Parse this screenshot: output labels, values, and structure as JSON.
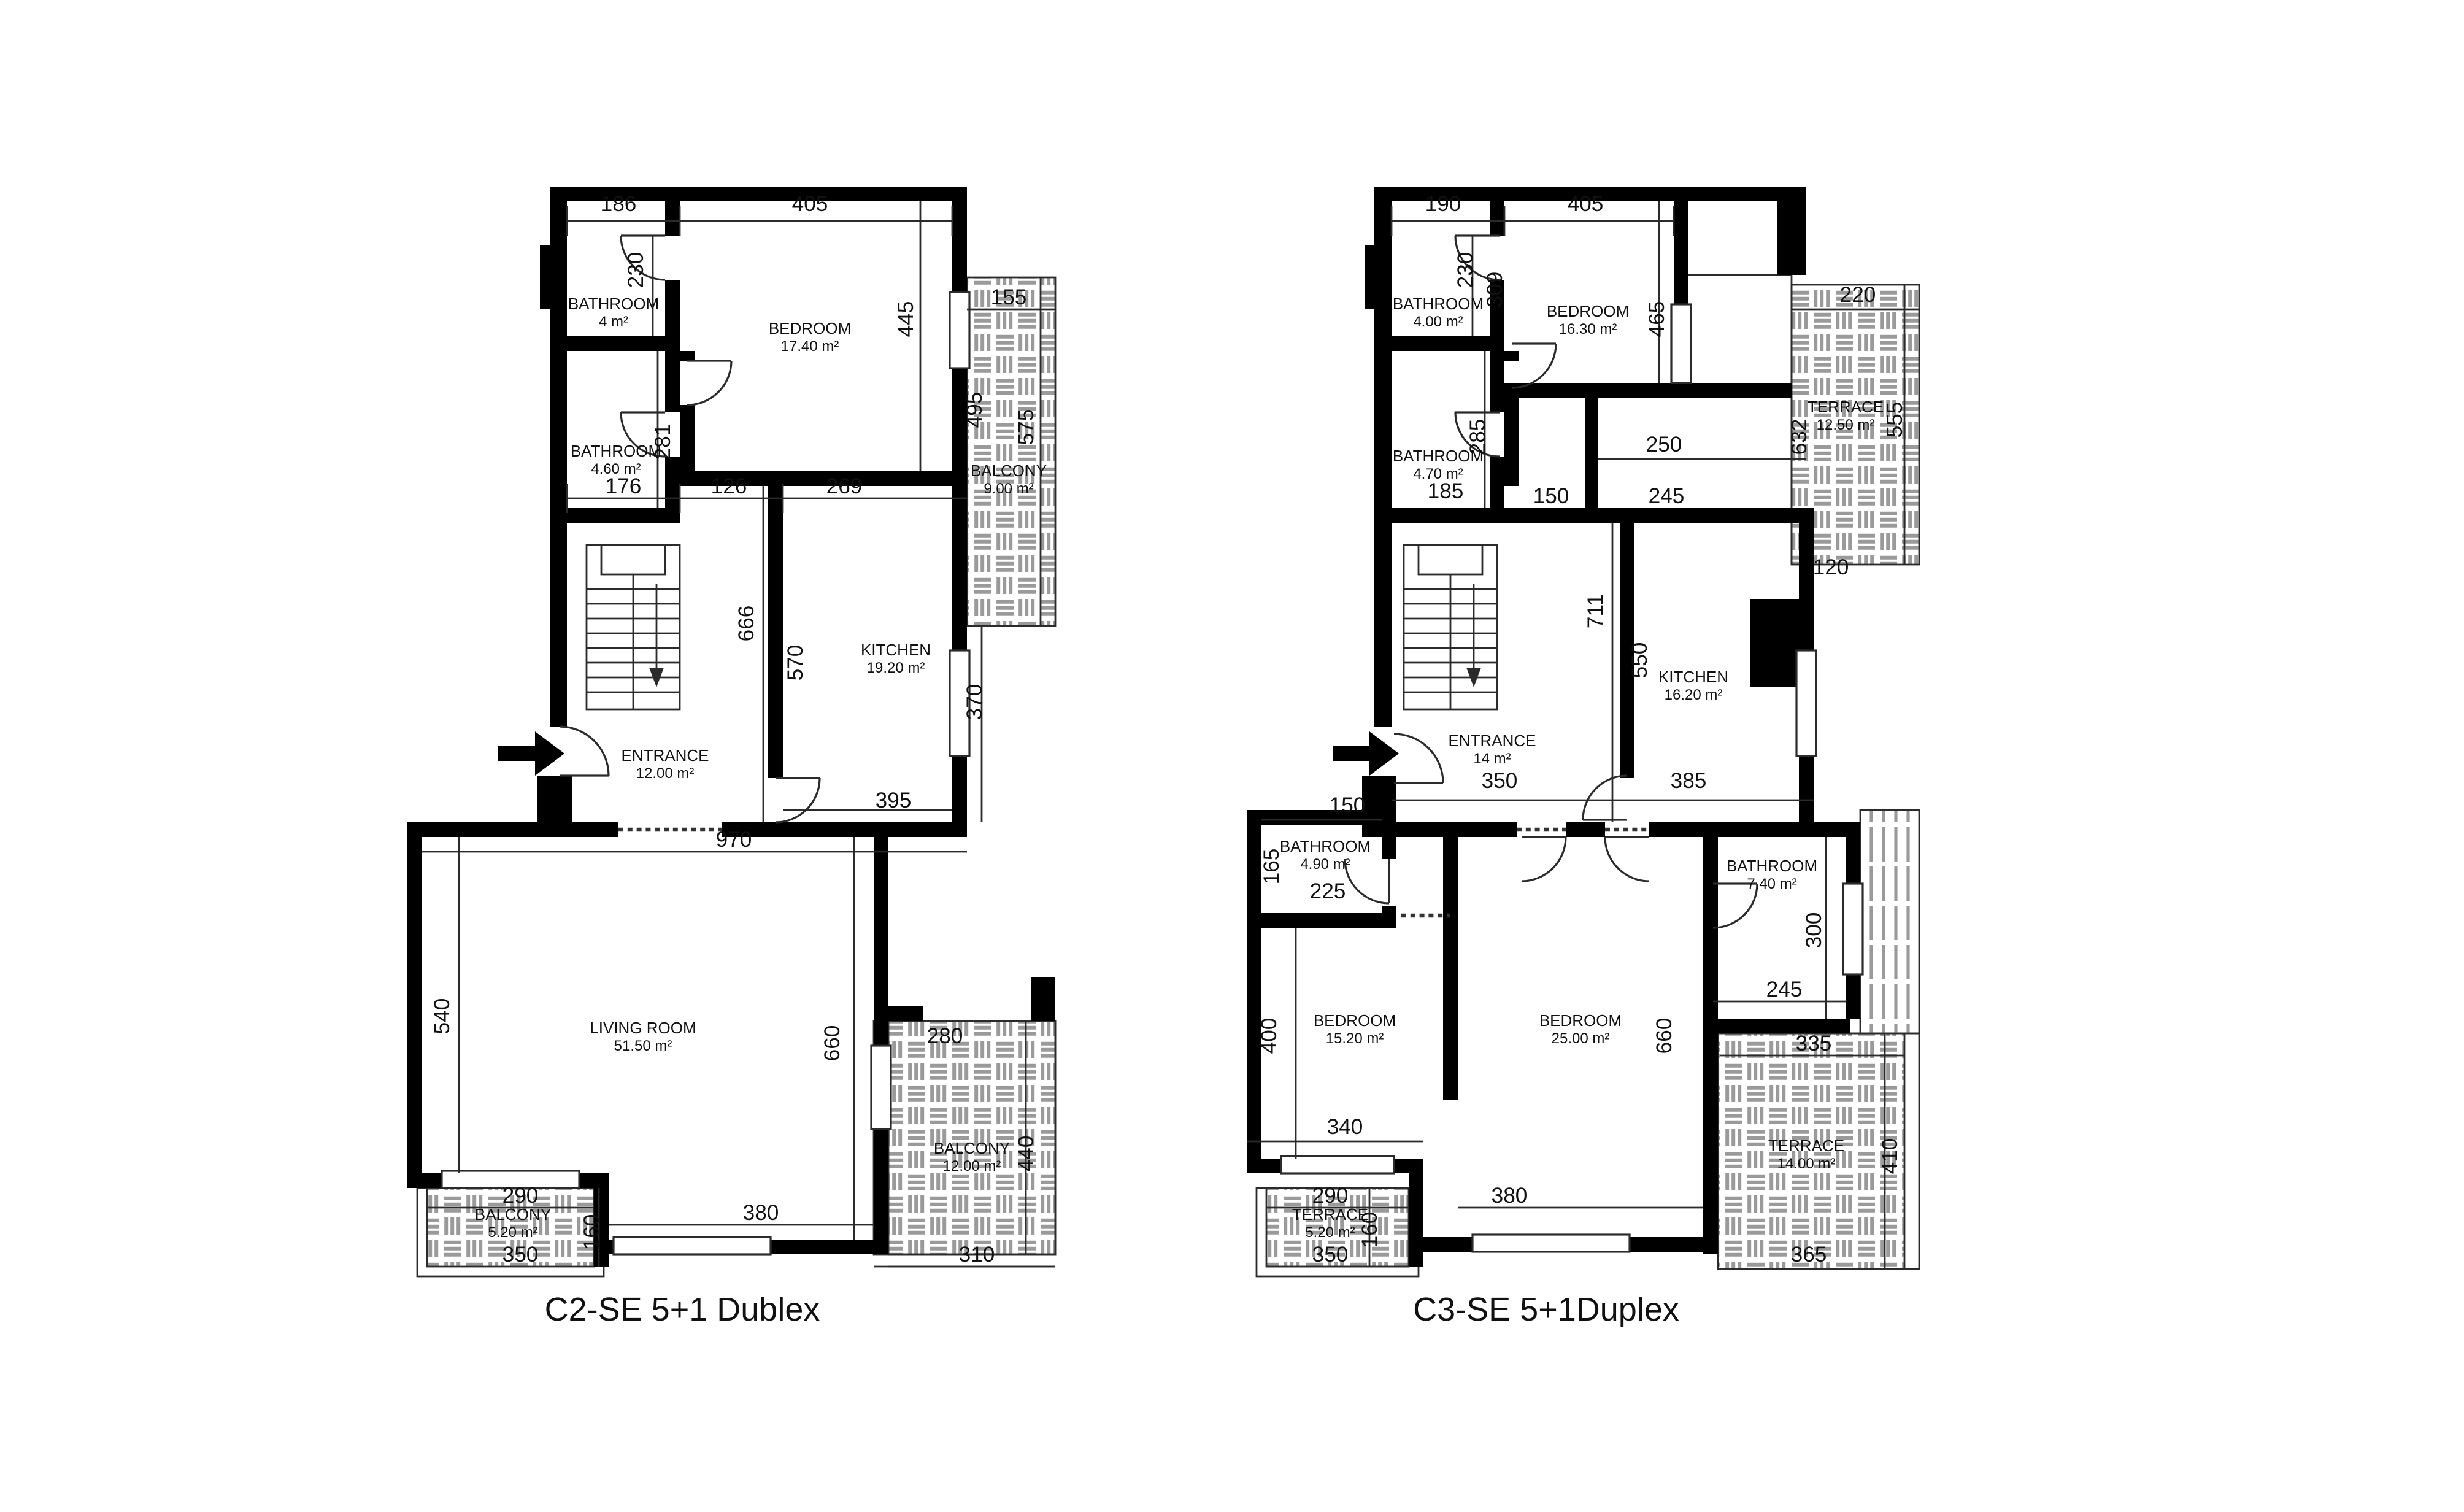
{
  "colors": {
    "wall": "#000000",
    "hatch_gray": "#9a9a9a",
    "line": "#2b2b2b",
    "text": "#111111",
    "background": "#ffffff"
  },
  "plans": [
    {
      "title": "C2-SE 5+1 Dublex",
      "rooms": [
        {
          "name": "BATHROOM",
          "area": "4 m²"
        },
        {
          "name": "BEDROOM",
          "area": "17.40 m²"
        },
        {
          "name": "BATHROOM",
          "area": "4.60 m²"
        },
        {
          "name": "BALCONY",
          "area": "9.00 m²"
        },
        {
          "name": "KITCHEN",
          "area": "19.20 m²"
        },
        {
          "name": "ENTRANCE",
          "area": "12.00 m²"
        },
        {
          "name": "LIVING ROOM",
          "area": "51.50 m²"
        },
        {
          "name": "BALCONY",
          "area": "12.00 m²"
        },
        {
          "name": "BALCONY",
          "area": "5.20 m²"
        }
      ],
      "dims": [
        "186",
        "405",
        "230",
        "445",
        "155",
        "495",
        "575",
        "281",
        "176",
        "126",
        "269",
        "666",
        "570",
        "370",
        "395",
        "970",
        "540",
        "660",
        "280",
        "440",
        "290",
        "160",
        "350",
        "380",
        "310"
      ]
    },
    {
      "title": "C3-SE 5+1Duplex",
      "rooms": [
        {
          "name": "BATHROOM",
          "area": "4.00 m²"
        },
        {
          "name": "BEDROOM",
          "area": "16.30 m²"
        },
        {
          "name": "BATHROOM",
          "area": "4.70 m²"
        },
        {
          "name": "TERRACE",
          "area": "12.50 m²"
        },
        {
          "name": "KITCHEN",
          "area": "16.20 m²"
        },
        {
          "name": "ENTRANCE",
          "area": "14 m²"
        },
        {
          "name": "BATHROOM",
          "area": "4.90 m²"
        },
        {
          "name": "BEDROOM",
          "area": "15.20 m²"
        },
        {
          "name": "BEDROOM",
          "area": "25.00 m²"
        },
        {
          "name": "BATHROOM",
          "area": "7.40 m²"
        },
        {
          "name": "TERRACE",
          "area": "14.00 m²"
        },
        {
          "name": "TERRACE",
          "area": "5.20 m²"
        }
      ],
      "dims": [
        "190",
        "405",
        "230",
        "309",
        "465",
        "220",
        "285",
        "185",
        "150",
        "250",
        "245",
        "632",
        "555",
        "120",
        "711",
        "550",
        "350",
        "385",
        "150",
        "165",
        "225",
        "400",
        "340",
        "660",
        "300",
        "245",
        "335",
        "410",
        "365",
        "290",
        "160",
        "350",
        "380"
      ]
    }
  ]
}
